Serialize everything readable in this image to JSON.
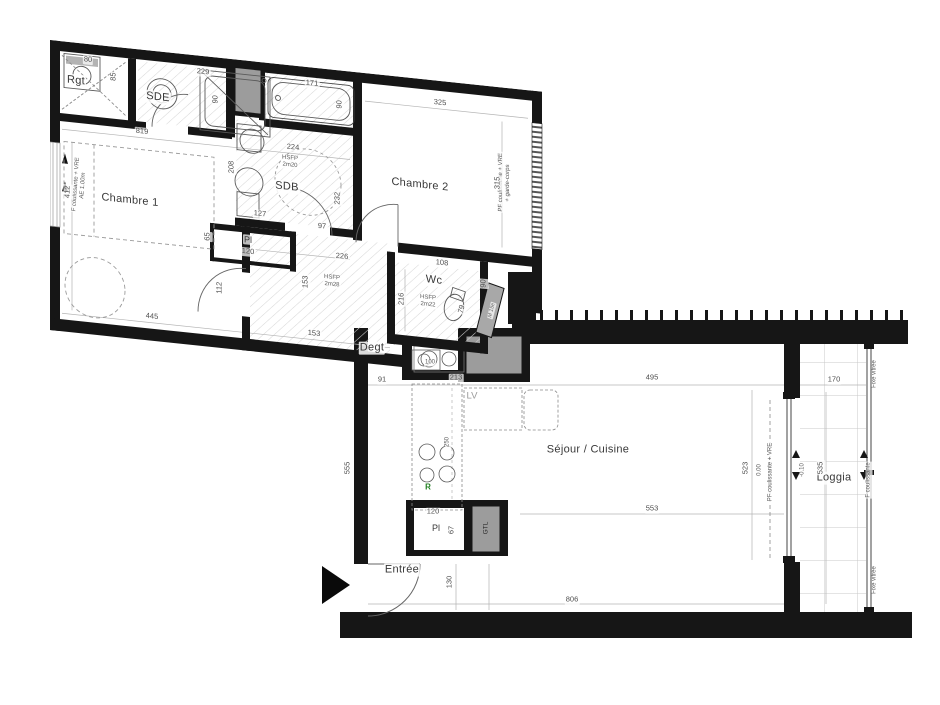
{
  "plan": {
    "type": "apartment-floor-plan",
    "colors": {
      "wall": "#161616",
      "duct_fill": "#9c9c9c",
      "hatch": "#d6d6d6",
      "dim_text": "#4e4e4e",
      "annotation_green": "#1e7e1e",
      "appliance_gray": "#9a9a9a"
    },
    "icons": {
      "entrance_arrow": "black-triangle-right"
    },
    "wing_labels": [
      {
        "t": "Rgt",
        "x": 26,
        "y": 38,
        "c": "room",
        "n": "room-label-rgt"
      },
      {
        "t": "SDE",
        "x": 108,
        "y": 46,
        "c": "room",
        "n": "room-label-sde"
      },
      {
        "t": "SDB",
        "x": 237,
        "y": 122,
        "c": "room",
        "n": "room-label-sdb"
      },
      {
        "t": "Chambre 1",
        "x": 80,
        "y": 152,
        "c": "room",
        "n": "room-label-chambre-1"
      },
      {
        "t": "Chambre 2",
        "x": 370,
        "y": 106,
        "c": "room",
        "n": "room-label-chambre-2"
      },
      {
        "t": "Wc",
        "x": 384,
        "y": 200,
        "c": "room",
        "n": "room-label-wc"
      },
      {
        "t": "HSFP\n2m20",
        "x": 240,
        "y": 97,
        "c": "tiny",
        "n": "height-annotation-sdb"
      },
      {
        "t": "HSFP\n2m28",
        "x": 282,
        "y": 212,
        "c": "tiny",
        "n": "height-annotation-hall"
      },
      {
        "t": "HSFP\n2m22",
        "x": 378,
        "y": 222,
        "c": "tiny",
        "n": "height-annotation-wc"
      },
      {
        "t": "F coulissante + VRE\nAE 1.00m",
        "x": 30,
        "y": 142,
        "r": -86,
        "c": "tiny",
        "n": "window-annotation-left"
      },
      {
        "t": "PF coulissante + VRE\n+ garde-corps",
        "x": 455,
        "y": 95,
        "r": -90,
        "c": "tiny",
        "n": "window-annotation-chambre2"
      },
      {
        "t": "M 15e",
        "x": 442,
        "y": 224,
        "r": -76,
        "c": "t5",
        "n": "duct-annotation"
      },
      {
        "t": "80",
        "x": 38,
        "y": 16,
        "c": "dim"
      },
      {
        "t": "85",
        "x": 64,
        "y": 30,
        "r": -90,
        "c": "dim"
      },
      {
        "t": "229",
        "x": 153,
        "y": 16,
        "c": "dim"
      },
      {
        "t": "90",
        "x": 166,
        "y": 42,
        "r": -90,
        "c": "dim"
      },
      {
        "t": "171",
        "x": 262,
        "y": 16,
        "c": "dim"
      },
      {
        "t": "90",
        "x": 290,
        "y": 34,
        "r": -90,
        "c": "dim"
      },
      {
        "t": "224",
        "x": 243,
        "y": 82,
        "c": "dim"
      },
      {
        "t": "232",
        "x": 288,
        "y": 128,
        "r": -90,
        "c": "dim"
      },
      {
        "t": "208",
        "x": 182,
        "y": 108,
        "r": -90,
        "c": "dim"
      },
      {
        "t": "127",
        "x": 210,
        "y": 152,
        "c": "dim"
      },
      {
        "t": "97",
        "x": 272,
        "y": 158,
        "c": "dim"
      },
      {
        "t": "819",
        "x": 92,
        "y": 82,
        "c": "dim"
      },
      {
        "t": "412",
        "x": 18,
        "y": 150,
        "r": -90,
        "c": "dim"
      },
      {
        "t": "445",
        "x": 102,
        "y": 266,
        "c": "dim"
      },
      {
        "t": "112",
        "x": 170,
        "y": 230,
        "r": -90,
        "c": "dim"
      },
      {
        "t": "153",
        "x": 256,
        "y": 215,
        "r": -90,
        "c": "dim"
      },
      {
        "t": "153",
        "x": 264,
        "y": 266,
        "c": "dim"
      },
      {
        "t": "65",
        "x": 158,
        "y": 180,
        "r": -90,
        "c": "dim"
      },
      {
        "t": "Pl",
        "x": 198,
        "y": 179,
        "c": "rm9",
        "n": "room-label-placard-1"
      },
      {
        "t": "120",
        "x": 198,
        "y": 191,
        "c": "dim"
      },
      {
        "t": "325",
        "x": 390,
        "y": 22,
        "c": "dim"
      },
      {
        "t": "315",
        "x": 448,
        "y": 96,
        "r": -90,
        "c": "dim"
      },
      {
        "t": "226",
        "x": 292,
        "y": 186,
        "c": "dim"
      },
      {
        "t": "216",
        "x": 352,
        "y": 222,
        "r": -90,
        "c": "dim"
      },
      {
        "t": "79",
        "x": 412,
        "y": 226,
        "r": -78,
        "c": "dim"
      },
      {
        "t": "90",
        "x": 434,
        "y": 198,
        "r": -90,
        "c": "dim"
      },
      {
        "t": "108",
        "x": 392,
        "y": 182,
        "c": "dim"
      }
    ],
    "main_labels": [
      {
        "t": "Degt",
        "x": 372,
        "y": 348,
        "c": "room",
        "n": "room-label-degt"
      },
      {
        "t": "Séjour / Cuisine",
        "x": 588,
        "y": 450,
        "c": "room",
        "n": "room-label-sejour-cuisine"
      },
      {
        "t": "Loggia",
        "x": 834,
        "y": 478,
        "c": "room",
        "n": "room-label-loggia"
      },
      {
        "t": "Entrée",
        "x": 402,
        "y": 570,
        "c": "room",
        "n": "room-label-entree"
      },
      {
        "t": "LV",
        "x": 472,
        "y": 397,
        "c": "gry",
        "n": "appliance-label-lv"
      },
      {
        "t": "R",
        "x": 428,
        "y": 487,
        "c": "grn",
        "n": "appliance-label-r"
      },
      {
        "t": "Pl",
        "x": 436,
        "y": 528,
        "c": "rm9",
        "n": "room-label-placard-2"
      },
      {
        "t": "120",
        "x": 433,
        "y": 512,
        "c": "dim"
      },
      {
        "t": "67",
        "x": 452,
        "y": 530,
        "r": -90,
        "c": "dim"
      },
      {
        "t": "GTL",
        "x": 486,
        "y": 528,
        "r": -90,
        "c": "dk",
        "n": "duct-label-gtl"
      },
      {
        "t": "100",
        "x": 430,
        "y": 363,
        "c": "tiny"
      },
      {
        "t": "91",
        "x": 382,
        "y": 380,
        "c": "dim"
      },
      {
        "t": "213",
        "x": 456,
        "y": 378,
        "c": "dim"
      },
      {
        "t": "250",
        "x": 448,
        "y": 442,
        "r": -90,
        "c": "tiny"
      },
      {
        "t": "555",
        "x": 348,
        "y": 468,
        "r": -90,
        "c": "dim"
      },
      {
        "t": "130",
        "x": 450,
        "y": 582,
        "r": -90,
        "c": "dim"
      },
      {
        "t": "806",
        "x": 572,
        "y": 600,
        "c": "dim"
      },
      {
        "t": "495",
        "x": 652,
        "y": 378,
        "c": "dim"
      },
      {
        "t": "553",
        "x": 652,
        "y": 509,
        "c": "dim"
      },
      {
        "t": "523",
        "x": 746,
        "y": 468,
        "r": -90,
        "c": "dim"
      },
      {
        "t": "0.00",
        "x": 760,
        "y": 470,
        "r": -90,
        "c": "tiny"
      },
      {
        "t": "PF coulissante + VRE",
        "x": 771,
        "y": 472,
        "r": -90,
        "c": "tiny",
        "n": "window-annotation-sejour"
      },
      {
        "t": "170",
        "x": 834,
        "y": 380,
        "c": "dim"
      },
      {
        "t": "535",
        "x": 821,
        "y": 468,
        "r": -90,
        "c": "dim"
      },
      {
        "t": "-0.10",
        "x": 803,
        "y": 470,
        "r": -90,
        "c": "tiny"
      },
      {
        "t": "Fixe vitrée",
        "x": 875,
        "y": 374,
        "r": -90,
        "c": "tiny",
        "n": "glazing-annotation-top"
      },
      {
        "t": "F coulissante",
        "x": 869,
        "y": 480,
        "r": -90,
        "c": "tiny",
        "n": "glazing-annotation-middle"
      },
      {
        "t": "Fixe vitrée",
        "x": 875,
        "y": 580,
        "r": -90,
        "c": "tiny",
        "n": "glazing-annotation-bottom"
      }
    ]
  }
}
